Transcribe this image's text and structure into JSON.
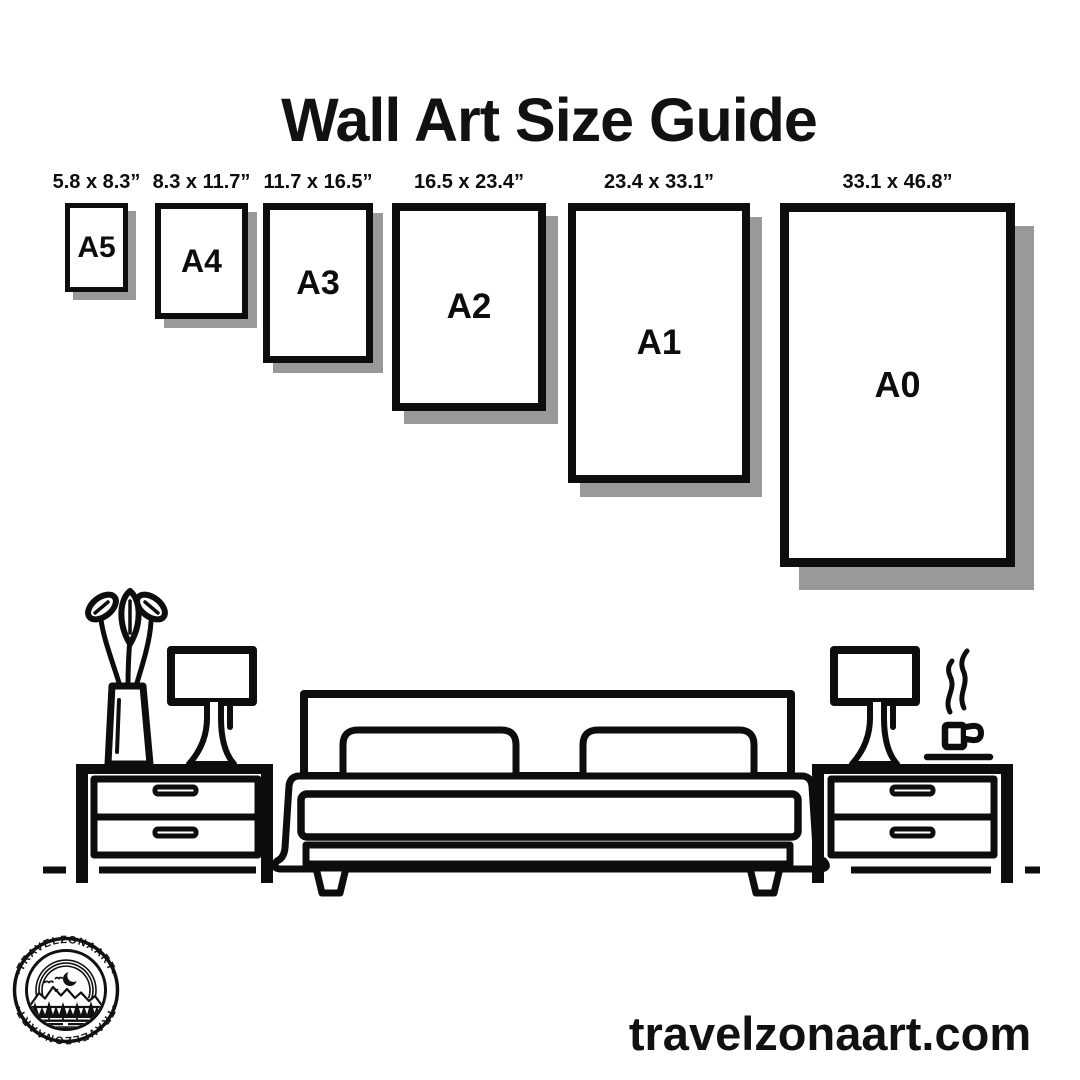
{
  "title": "Wall Art Size Guide",
  "sizes": [
    {
      "name": "A5",
      "dims": "5.8 x 8.3”"
    },
    {
      "name": "A4",
      "dims": "8.3 x 11.7”"
    },
    {
      "name": "A3",
      "dims": "11.7 x 16.5”"
    },
    {
      "name": "A2",
      "dims": "16.5 x 23.4”"
    },
    {
      "name": "A1",
      "dims": "23.4 x 33.1”"
    },
    {
      "name": "A0",
      "dims": "33.1 x 46.8”"
    }
  ],
  "logo": {
    "arc_top": "•TRAVELZONAART•",
    "arc_bottom": "•TRAVELZONAART•"
  },
  "footer": {
    "website": "travelzonaart.com"
  },
  "colors": {
    "ink": "#111111",
    "shadow": "#999999",
    "background": "#ffffff"
  }
}
